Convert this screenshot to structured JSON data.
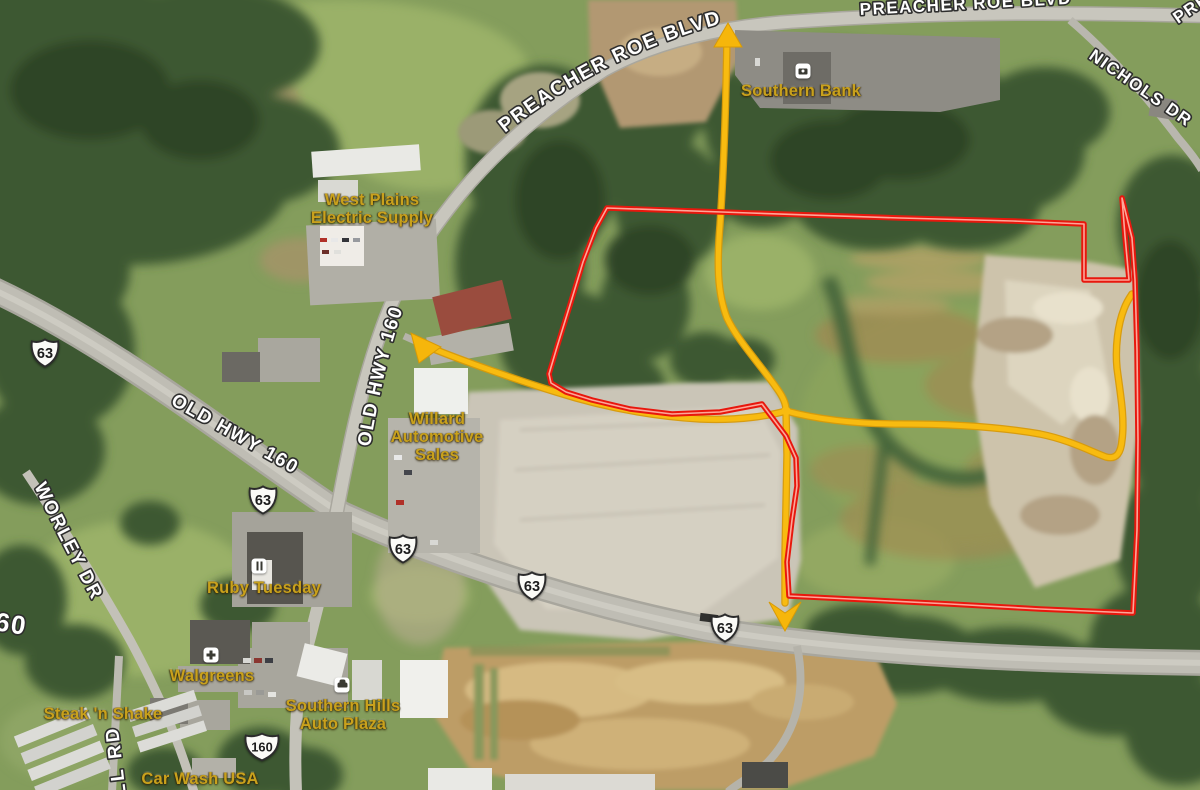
{
  "map": {
    "view": "aerial-satellite",
    "colors": {
      "property_boundary": "#e8170d",
      "highlight_route": "#f6b60b",
      "place_label": "#c9a11c",
      "road_label": "#ffffff",
      "road_label_outline": "#2e2e2e"
    },
    "road_labels": [
      {
        "id": "preacher-roe-blvd-west",
        "text": "PREACHER ROE BLVD"
      },
      {
        "id": "preacher-roe-blvd-north",
        "text": "PREACHER ROE BLVD"
      },
      {
        "id": "preacher-roe-blvd-corner",
        "text": "PREACHER ROE BLVD"
      },
      {
        "id": "nichols-dr",
        "text": "NICHOLS DR"
      },
      {
        "id": "old-hwy-160-vertical",
        "text": "OLD HWY 160"
      },
      {
        "id": "old-hwy-160-diagonal",
        "text": "OLD HWY 160"
      },
      {
        "id": "worley-dr",
        "text": "WORLEY DR"
      },
      {
        "id": "ll-rd-partial",
        "text": "LL RD"
      },
      {
        "id": "route-160-partial",
        "text": "60"
      }
    ],
    "route_shields": [
      {
        "route": "63"
      },
      {
        "route": "63"
      },
      {
        "route": "63"
      },
      {
        "route": "63"
      },
      {
        "route": "63"
      },
      {
        "route": "160"
      }
    ],
    "places": [
      {
        "id": "southern-bank",
        "lines": [
          "Southern Bank"
        ],
        "icon": "bank"
      },
      {
        "id": "west-plains-electric",
        "lines": [
          "West Plains",
          "Electric Supply"
        ],
        "icon": null
      },
      {
        "id": "willard-automotive-sales",
        "lines": [
          "Willard",
          "Automotive",
          "Sales"
        ],
        "icon": null
      },
      {
        "id": "ruby-tuesday",
        "lines": [
          "Ruby Tuesday"
        ],
        "icon": "restaurant"
      },
      {
        "id": "walgreens",
        "lines": [
          "Walgreens"
        ],
        "icon": "store"
      },
      {
        "id": "steak-n-shake",
        "lines": [
          "Steak 'n Shake"
        ],
        "icon": null
      },
      {
        "id": "southern-hills-auto-plaza",
        "lines": [
          "Southern Hills",
          "Auto Plaza"
        ],
        "icon": "car"
      },
      {
        "id": "car-wash-usa",
        "lines": [
          "Car Wash USA"
        ],
        "icon": null
      }
    ],
    "overlays": {
      "property_boundary": {
        "color": "#e8170d",
        "points": "607,208 750,213 900,218 1013,221 1084,224 1084,280 1129,280 1125,236 1122,198 1132,238 1135,280 1137,350 1138,440 1137,530 1133,613 1040,609 950,604 870,600 789,596 787,562 792,520 797,486 796,458 786,436 771,416 762,404 720,412 672,414 630,409 592,400 566,392 551,383 549,374 557,347 570,305 583,262 596,228"
      },
      "routes": {
        "color": "#f6b60b",
        "north_access": {
          "d": "M727,32 C726,110 723,180 720,225 C717,262 717,292 727,318 C738,341 760,364 778,390 C783,397 786,404 786,410"
        },
        "west_access": {
          "d": "M429,347 C460,360 520,381 556,392 C600,406 650,416 700,419 C740,421 772,415 786,411"
        },
        "east_spur": {
          "d": "M786,411 C820,420 860,424 900,424 C950,424 1000,427 1040,434 C1070,440 1092,452 1106,457 C1117,460 1121,452 1122,440 C1125,418 1120,392 1117,368 C1115,347 1118,324 1124,309 C1127,301 1130,297 1132,294"
        },
        "south_access": {
          "d": "M786,411 L787,455 786,505 785,555 785,603"
        }
      }
    }
  }
}
